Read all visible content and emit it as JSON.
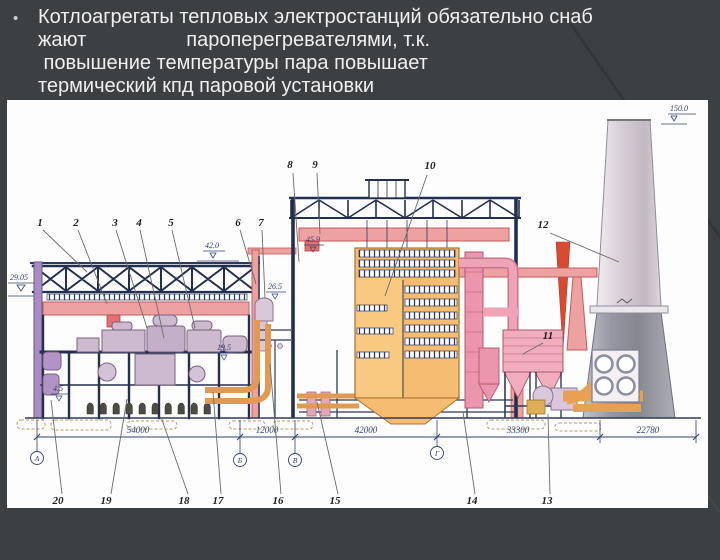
{
  "slide": {
    "bullet": "•",
    "lines": [
      "Котлоагрегаты тепловых электростанций обязательно снаб",
      "жают                  пароперегревателями, т.к.",
      " повышение температуры пара повышает",
      "термический кпд паровой установки"
    ]
  },
  "diagram": {
    "callout_numbers": [
      "1",
      "2",
      "3",
      "4",
      "5",
      "6",
      "7",
      "8",
      "9",
      "10",
      "11",
      "12",
      "13",
      "14",
      "15",
      "16",
      "17",
      "18",
      "19",
      "20"
    ],
    "dimensions": [
      "54000",
      "12000",
      "42000",
      "33300",
      "22780"
    ],
    "axis_labels": [
      "А",
      "Б",
      "В",
      "Г"
    ],
    "elevations": {
      "crane_rail": "29.05",
      "condenser_floor": "4.5",
      "turbine_deck": "19.5",
      "deaerator_roof": "42.0",
      "deaerator_mid": "26.5",
      "boiler_crane": "45.9",
      "stack_top": "150.0"
    }
  },
  "colors": {
    "slide_background": "#3d4043",
    "text": "#f0f0f0",
    "crane_girder": "#eea1a1",
    "boiler_furnace": "#f5b96a",
    "gas_duct_pink": "#ec96ab",
    "stack_gray": "#9b9ba6",
    "structure_navy": "#2e3a5c"
  }
}
